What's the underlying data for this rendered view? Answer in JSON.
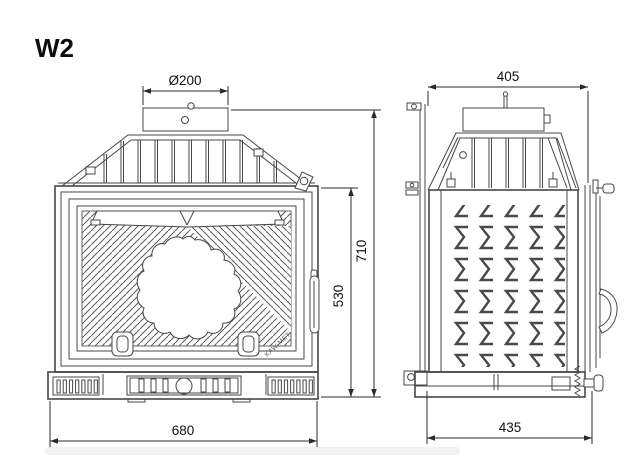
{
  "drawing": {
    "model": "W2",
    "brand": "KAW-MET",
    "line_color": "#474747",
    "background": "#ffffff",
    "dimensions": {
      "flue_diameter": "Ø200",
      "top_depth": "405",
      "total_height": "710",
      "door_height": "530",
      "width": "680",
      "base_depth": "435"
    }
  }
}
